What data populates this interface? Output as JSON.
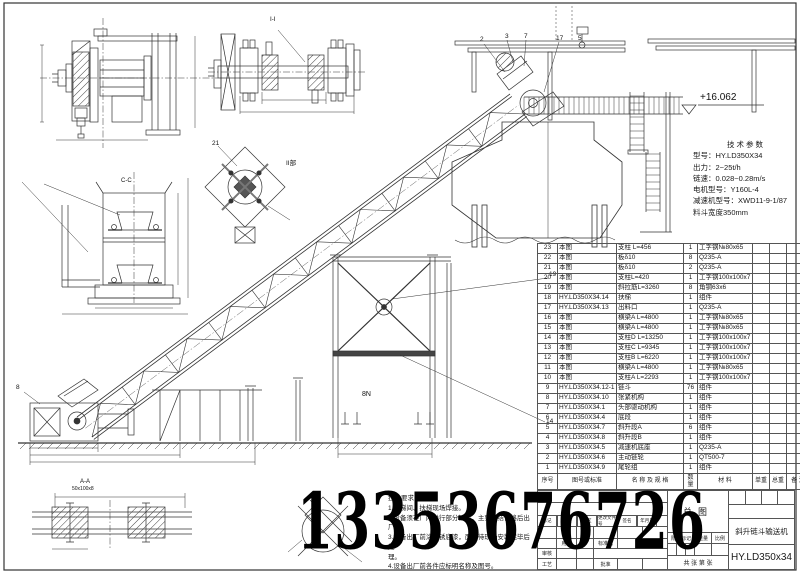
{
  "sheet": {
    "watermark": "13353676726"
  },
  "tech_params": {
    "title": "技术参数",
    "lines": [
      "型号：HY.LD350X34",
      "出力：2~25t/h",
      "链速：0.028~0.28m/s",
      "电机型号：Y160L-4",
      "减速机型号：XWD11-9-1/87",
      "料斗宽度350mm"
    ]
  },
  "tech_notes": {
    "title": "技术要求：",
    "lines": [
      "1.楼梯间、扶梯现场焊接。",
      "2.设备须在厂内进行部分试装，主要联结合格后出厂。",
      "3.设备出厂前涂防锈底漆，面漆待现场安装完毕后处",
      "理。",
      "4.设备出厂前各件应标明名称及图号。"
    ]
  },
  "annotations": {
    "elevation_top": "+16.062",
    "section_cc": "C-C",
    "section_ii_label": "Ⅰ-Ⅰ",
    "detail_ii": "II部",
    "section_aa": "A-A",
    "rail_spec": "50x100x8",
    "weld_note": "8N",
    "balloon_2": "2",
    "balloon_3": "3",
    "balloon_7": "7",
    "balloon_17": "17",
    "balloon_5": "5",
    "balloon_8": "8",
    "balloon_21": "21",
    "balloon_19": "19",
    "balloon_14": "14"
  },
  "parts_table": {
    "headers": {
      "no": "序号",
      "code": "图号或标准",
      "name": "名 称 及 规 格",
      "qty": "数量",
      "material": "材  料",
      "unit_weight": "单重",
      "total_weight": "总重",
      "remark": "备 注"
    },
    "rows": [
      {
        "no": "23",
        "code": "本图",
        "name": "支柱 L=456",
        "qty": "1",
        "material": "工字钢№80x65",
        "uw": "",
        "tw": "",
        "rem": ""
      },
      {
        "no": "22",
        "code": "本图",
        "name": "板δ10",
        "qty": "8",
        "material": "Q235-A",
        "uw": "",
        "tw": "",
        "rem": ""
      },
      {
        "no": "21",
        "code": "本图",
        "name": "板δ10",
        "qty": "2",
        "material": "Q235-A",
        "uw": "",
        "tw": "",
        "rem": ""
      },
      {
        "no": "20",
        "code": "本图",
        "name": "支柱L=420",
        "qty": "1",
        "material": "工字钢100x100x7",
        "uw": "",
        "tw": "",
        "rem": ""
      },
      {
        "no": "19",
        "code": "本图",
        "name": "斜拉筋L=3260",
        "qty": "8",
        "material": "角钢63x6",
        "uw": "",
        "tw": "",
        "rem": ""
      },
      {
        "no": "18",
        "code": "HY.LD350X34.14",
        "name": "扶梯",
        "qty": "1",
        "material": "组件",
        "uw": "",
        "tw": "",
        "rem": ""
      },
      {
        "no": "17",
        "code": "HY.LD350X34.13",
        "name": "出料口",
        "qty": "1",
        "material": "Q235-A",
        "uw": "",
        "tw": "",
        "rem": ""
      },
      {
        "no": "16",
        "code": "本图",
        "name": "横梁A L=4800",
        "qty": "1",
        "material": "工字钢№80x65",
        "uw": "",
        "tw": "",
        "rem": ""
      },
      {
        "no": "15",
        "code": "本图",
        "name": "横梁A L=4800",
        "qty": "1",
        "material": "工字钢№80x65",
        "uw": "",
        "tw": "",
        "rem": ""
      },
      {
        "no": "14",
        "code": "本图",
        "name": "支柱D L=13250",
        "qty": "1",
        "material": "工字钢100x100x7",
        "uw": "",
        "tw": "",
        "rem": ""
      },
      {
        "no": "13",
        "code": "本图",
        "name": "支柱C L=9345",
        "qty": "1",
        "material": "工字钢100x100x7",
        "uw": "",
        "tw": "",
        "rem": ""
      },
      {
        "no": "12",
        "code": "本图",
        "name": "支柱B L=6220",
        "qty": "1",
        "material": "工字钢100x100x7",
        "uw": "",
        "tw": "",
        "rem": ""
      },
      {
        "no": "11",
        "code": "本图",
        "name": "横梁A L=4800",
        "qty": "1",
        "material": "工字钢№80x65",
        "uw": "",
        "tw": "",
        "rem": ""
      },
      {
        "no": "10",
        "code": "本图",
        "name": "支柱A L=2293",
        "qty": "1",
        "material": "工字钢100x100x7",
        "uw": "",
        "tw": "",
        "rem": ""
      },
      {
        "no": "9",
        "code": "HY.LD350X34.12-1",
        "name": "链斗",
        "qty": "76",
        "material": "组件",
        "uw": "",
        "tw": "",
        "rem": ""
      },
      {
        "no": "8",
        "code": "HY.LD350X34.10",
        "name": "张紧机构",
        "qty": "1",
        "material": "组件",
        "uw": "",
        "tw": "",
        "rem": ""
      },
      {
        "no": "7",
        "code": "HY.LD350X34.1",
        "name": "头部驱动机构",
        "qty": "1",
        "material": "组件",
        "uw": "",
        "tw": "",
        "rem": ""
      },
      {
        "no": "6",
        "code": "HY.LD350X34.4",
        "name": "底段",
        "qty": "1",
        "material": "组件",
        "uw": "",
        "tw": "",
        "rem": ""
      },
      {
        "no": "5",
        "code": "HY.LD350X34.7",
        "name": "斜升段A",
        "qty": "6",
        "material": "组件",
        "uw": "",
        "tw": "",
        "rem": ""
      },
      {
        "no": "4",
        "code": "HY.LD350X34.8",
        "name": "斜升段B",
        "qty": "1",
        "material": "组件",
        "uw": "",
        "tw": "",
        "rem": ""
      },
      {
        "no": "3",
        "code": "HY.LD350X34.5",
        "name": "减速机底座",
        "qty": "1",
        "material": "Q235-A",
        "uw": "",
        "tw": "",
        "rem": ""
      },
      {
        "no": "2",
        "code": "HY.LD350X34.6",
        "name": "主动链轮",
        "qty": "1",
        "material": "QT500-7",
        "uw": "",
        "tw": "",
        "rem": ""
      },
      {
        "no": "1",
        "code": "HY.LD350X34.9",
        "name": "尾轮组",
        "qty": "1",
        "material": "组件",
        "uw": "",
        "tw": "",
        "rem": ""
      }
    ]
  },
  "title_block": {
    "drawing_type": "总图",
    "product_name": "斜升链斗输送机",
    "drawing_no": "HY.LD350x34",
    "revision_labels": [
      "标记",
      "处数",
      "分区",
      "更改文件号",
      "签名",
      "年月日"
    ],
    "roles": {
      "user": "用户",
      "standard": "标准化",
      "audit": "审核",
      "process": "工艺",
      "approve": "批准"
    },
    "stage_row": {
      "stage": "阶段标记",
      "weight": "重量",
      "scale": "比例"
    },
    "sheet_info": "共  张 第  张"
  }
}
